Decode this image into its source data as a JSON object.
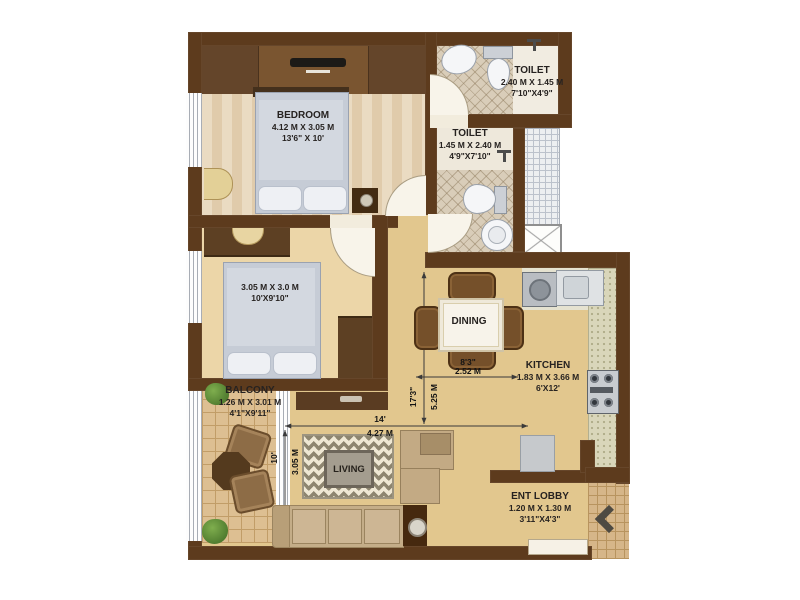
{
  "rooms": {
    "bedroom_top": {
      "name": "BEDROOM",
      "metric": "4.12 M X 3.05 M",
      "imperial": "13'6\" X 10'"
    },
    "bedroom_mid": {
      "name": "BEDROOM",
      "metric": "3.05 M X 3.0 M",
      "imperial": "10'X9'10\""
    },
    "toilet_top": {
      "name": "TOILET",
      "metric": "2.40 M X 1.45 M",
      "imperial": "7'10\"X4'9\""
    },
    "toilet_mid": {
      "name": "TOILET",
      "metric": "1.45 M X 2.40 M",
      "imperial": "4'9\"X7'10\""
    },
    "kitchen": {
      "name": "KITCHEN",
      "metric": "1.83 M X 3.66 M",
      "imperial": "6'X12'"
    },
    "balcony": {
      "name": "BALCONY",
      "metric": "1.26 M X 3.01 M",
      "imperial": "4'1\"X9'11\""
    },
    "ent_lobby": {
      "name": "ENT LOBBY",
      "metric": "1.20 M X 1.30 M",
      "imperial": "3'11\"X4'3\""
    },
    "dining": {
      "name": "DINING"
    },
    "living": {
      "name": "LIVING"
    }
  },
  "dimensions": {
    "passage_depth": {
      "imperial": "17'3\"",
      "metric": "5.25 M"
    },
    "dining_width": {
      "imperial": "8'3\"",
      "metric": "2.52 M"
    },
    "living_width": {
      "imperial": "14'",
      "metric": "4.27 M"
    },
    "living_depth": {
      "imperial": "10'",
      "metric": "3.05 M"
    }
  },
  "colors": {
    "wall": "#5d3b1d",
    "main_floor": "#e2c78e",
    "bedroom_top_floor": "#e9d8bf",
    "bedroom_mid_floor": "#ecd6a8",
    "dimension_text": "#141414",
    "entry_arrow": "#4e4a42"
  }
}
